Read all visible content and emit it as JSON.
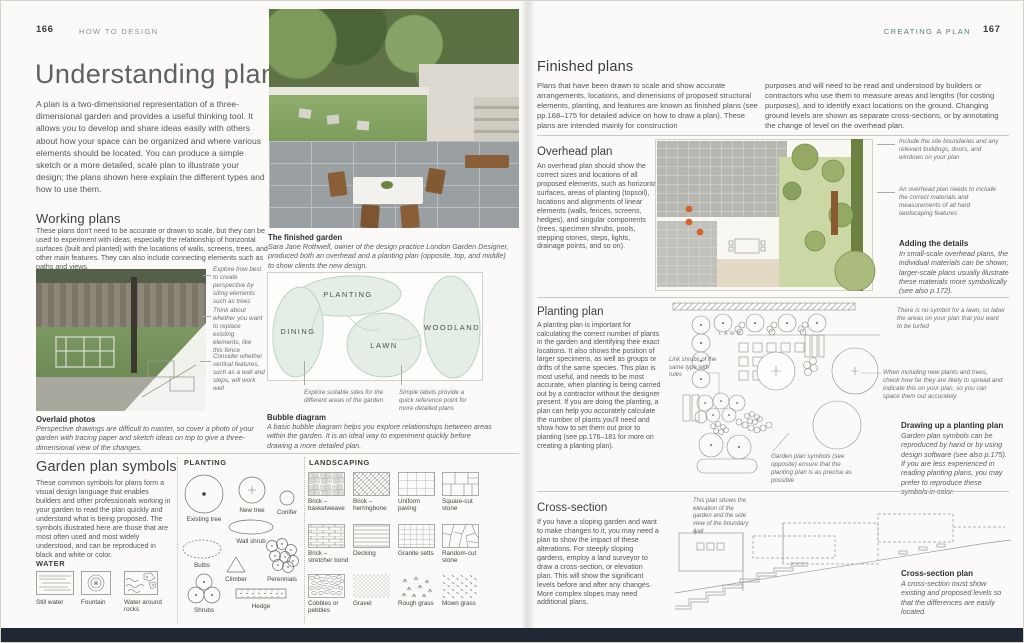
{
  "header_left": {
    "page_number": "166",
    "section": "HOW TO DESIGN"
  },
  "header_right": {
    "page_number": "167",
    "section": "CREATING A PLAN"
  },
  "left": {
    "title": "Understanding plans",
    "intro": "A plan is a two-dimensional representation of a three-dimensional garden and provides a useful thinking tool. It allows you to develop and share ideas easily with others about how your space can be organized and where various elements should be located. You can produce a simple sketch or a more detailed, scale plan to illustrate your design; the plans shown here explain the different types and how to use them.",
    "working_plans": {
      "heading": "Working plans",
      "body": "These plans don't need to be accurate or drawn to scale, but they can be used to experiment with ideas, especially the relationship of horizontal surfaces (built and planted) with the locations of walls, screens, trees, and other main features. They can also include connecting elements such as paths and views.",
      "annotations": [
        "Explore how best to create perspective by siting elements such as trees",
        "Think about whether you want to replace existing elements, like this fence",
        "Consider whether vertical features, such as a wall and steps, will work well"
      ]
    },
    "overlaid_photos": {
      "title": "Overlaid photos",
      "body": "Perspective drawings are difficult to master, so cover a photo of your garden with tracing paper and sketch ideas on top to give a three-dimensional view of the changes."
    },
    "finished_garden": {
      "title": "The finished garden",
      "body": "Sara Jane Rothwell, owner of the design practice London Garden Designer, produced both an overhead and a planting plan (opposite, top, and middle) to show clients the new design."
    },
    "bubble": {
      "planting": "PLANTING",
      "dining": "DINING",
      "woodland": "WOODLAND",
      "lawn": "LAWN",
      "ann_left": "Explore suitable sites for the different areas of the garden",
      "ann_right": "Simple labels provide a quick reference point for more detailed plans",
      "cap_title": "Bubble diagram",
      "cap_body": "A basic bubble diagram helps you explore relationships between areas within the garden. It is an ideal way to experiment quickly before drawing a more detailed plan."
    },
    "symbols": {
      "heading": "Garden plan symbols",
      "body": "These common symbols for plans form a visual design language that enables builders and other professionals working in your garden to read the plan quickly and understand what is being proposed. The symbols illustrated here are those that are most often used and most widely understood, and can be reproduced in black and white or color.",
      "water_heading": "WATER",
      "water_items": [
        "Still water",
        "Fountain",
        "Water around rocks"
      ],
      "planting_heading": "PLANTING",
      "planting_items": [
        "Existing tree",
        "New tree",
        "Conifer",
        "Wall shrub",
        "Bulbs",
        "Climber",
        "Perennials",
        "Shrubs",
        "Hedge"
      ],
      "landscaping_heading": "LANDSCAPING",
      "landscaping_items": [
        "Brick – basketweave",
        "Brick – herringbone",
        "Uniform paving",
        "Square-cut stone",
        "Brick – stretcher bond",
        "Decking",
        "Granite setts",
        "Random-cut stone",
        "Cobbles or pebbles",
        "Gravel",
        "Rough grass",
        "Mown grass"
      ]
    }
  },
  "right": {
    "finished_plans": {
      "heading": "Finished plans",
      "col1": "Plans that have been drawn to scale and show accurate arrangements, locations, and dimensions of proposed structural elements, planting, and features are known as finished plans (see pp.168–175 for detailed advice on how to draw a plan). These plans are intended mainly for construction",
      "col2": "purposes and will need to be read and understood by builders or contractors who use them to measure areas and lengths (for costing purposes), and to identify exact locations on the ground. Changing ground levels are shown as separate cross-sections, or by annotating the change of level on the overhead plan."
    },
    "overhead": {
      "heading": "Overhead plan",
      "body": "An overhead plan should show the correct sizes and locations of all proposed elements, such as horizontal surfaces, areas of planting (topsoil), locations and alignments of linear elements (walls, fences, screens, hedges), and singular components (trees, specimen shrubs, pools, stepping stones, steps, lights, drainage points, and so on).",
      "ann1": "Include the site boundaries and any relevant buildings, doors, and windows on your plan",
      "ann2": "An overhead plan needs to include the correct materials and measurements of all hard landscaping features",
      "details_title": "Adding the details",
      "details_body": "In small-scale overhead plans, the individual materials can be shown; larger-scale plans usually illustrate these materials more symbolically (see also p.172)."
    },
    "planting": {
      "heading": "Planting plan",
      "body": "A planting plan is important for calculating the correct number of plants in the garden and identifying their exact locations. It also shows the position of larger specimens, as well as groups or drifts of the same species. This plan is most useful, and needs to be most accurate, when planting is being carried out by a contractor without the designer present. If you are doing the planting, a plan can help you accurately calculate the number of plants you'll need and show how to set them out prior to planting (see pp.176–181 for more on creating a planting plan).",
      "lawn": "LAWN",
      "ann_lawn": "There is no symbol for a lawn, so label the areas on your plan that you want to be turfed",
      "ann_link": "Link shrubs of the same type with rules",
      "ann_spread": "When including new plants and trees, check how far they are likely to spread and indicate this on your plan, so you can space them out accurately",
      "ann_symbols": "Garden plan symbols (see opposite) ensure that the planting plan is as precise as possible",
      "drawing_title": "Drawing up a planting plan",
      "drawing_body": "Garden plan symbols can be reproduced by hand or by using design software (see also p.175). If you are less experienced in reading planting plans, you may prefer to reproduce these symbols in color."
    },
    "cross": {
      "heading": "Cross-section",
      "body": "If you have a sloping garden and want to make changes to it, you may need a plan to show the impact of these alterations. For steeply sloping gardens, employ a land surveyor to draw a cross-section, or elevation plan. This will show the significant levels before and after any changes. More complex slopes may need additional plans.",
      "ann": "This plan shows the elevation of the garden and the side view of the boundary wall",
      "cap_title": "Cross-section plan",
      "cap_body": "A cross-section must show existing and proposed levels so that the differences are easily located."
    }
  },
  "colors": {
    "accent_teal": "#52836f",
    "bubble_fill": "#e4ede6",
    "bubble_stroke": "#b9cfc0",
    "bottom_band": "#202834",
    "plan_tree_green": "#93a964",
    "plan_orange": "#d2622e"
  }
}
